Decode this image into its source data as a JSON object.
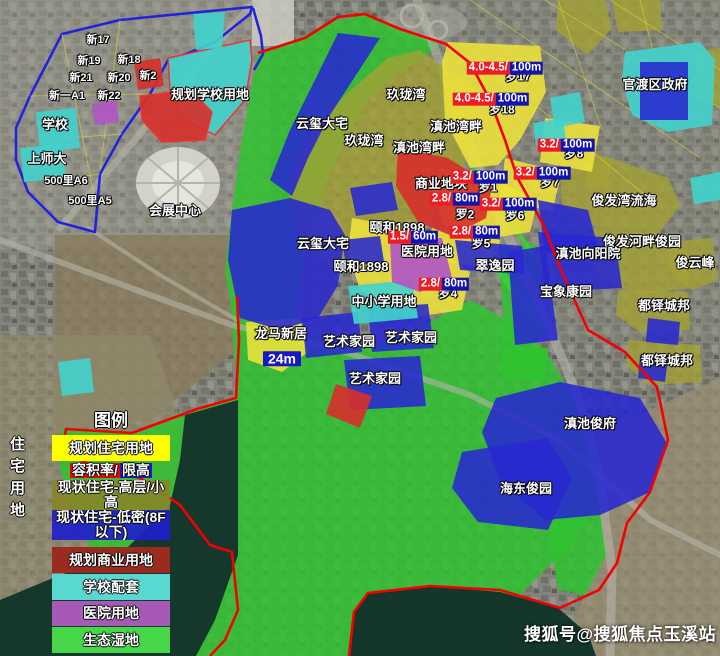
{
  "watermark": "搜狐号@搜狐焦点玉溪站",
  "left_edge_vertical_text": "住宅用地",
  "legend": {
    "title": "图例",
    "items": [
      {
        "type": "plain",
        "text": "规划住宅用地",
        "bg": "#ffff00",
        "h": 26,
        "gap": 0
      },
      {
        "type": "split",
        "h": 17,
        "gap": 1,
        "parts": [
          {
            "text": "容积率/",
            "bg": "#f00000"
          },
          {
            "text": "限高",
            "bg": "#1b1bc4"
          }
        ]
      },
      {
        "type": "plain",
        "text": "现状住宅-高层/小高",
        "bg": "rgba(134,134,40,0.9)",
        "h": 30,
        "gap": 1
      },
      {
        "type": "plain",
        "text": "现状住宅-低密(8F以下)",
        "bg": "rgba(32,32,204,0.92)",
        "h": 30,
        "gap": 0
      },
      {
        "type": "plain",
        "text": "规划商业用地",
        "bg": "#9c2b1f",
        "h": 26,
        "gap": 7
      },
      {
        "type": "plain",
        "text": "学校配套",
        "bg": "#58d8d0",
        "h": 26,
        "gap": 1
      },
      {
        "type": "plain",
        "text": "医院用地",
        "bg": "#a75ab5",
        "h": 25,
        "gap": 1
      },
      {
        "type": "plain",
        "text": "生态湿地",
        "bg": "#47d549",
        "h": 26,
        "gap": 1
      }
    ]
  },
  "palette": {
    "planned_residential_yellow": "#eee23a",
    "existing_highrise_olive": "#a4a134",
    "existing_lowdensity_blue": "#2828d0",
    "eco_wetland_green": "#2fc32f",
    "school_cyan": "#41d3cd",
    "commercial_red": "#d6312b",
    "hospital_purple": "#b156c3",
    "plot_ratio_bg_red": "#ee1c25",
    "height_limit_bg_navy": "#1515ad",
    "boundary_red": "#f50000",
    "boundary_blue": "#2121e0"
  },
  "map_labels": [
    {
      "t": "blocksm",
      "text": "新17",
      "x": 98,
      "y": 40
    },
    {
      "t": "blocksm",
      "text": "新19",
      "x": 89,
      "y": 61
    },
    {
      "t": "blocksm",
      "text": "新18",
      "x": 129,
      "y": 60
    },
    {
      "t": "blocksm",
      "text": "新21",
      "x": 81,
      "y": 78
    },
    {
      "t": "blocksm",
      "text": "新20",
      "x": 119,
      "y": 78
    },
    {
      "t": "blocksm",
      "text": "新2",
      "x": 148,
      "y": 76
    },
    {
      "t": "blocksm",
      "text": "新一A1",
      "x": 67,
      "y": 96
    },
    {
      "t": "blocksm",
      "text": "新22",
      "x": 109,
      "y": 96
    },
    {
      "t": "blocksm",
      "text": "500里A6",
      "x": 66,
      "y": 181
    },
    {
      "t": "blocksm",
      "text": "500里A5",
      "x": 90,
      "y": 201
    },
    {
      "t": "place",
      "text": "学校",
      "x": 55,
      "y": 125
    },
    {
      "t": "place",
      "text": "上师大",
      "x": 47,
      "y": 159
    },
    {
      "t": "place",
      "text": "规划学校用地",
      "x": 210,
      "y": 95
    },
    {
      "t": "place",
      "text": "会展中心",
      "x": 175,
      "y": 211
    },
    {
      "t": "place",
      "text": "云玺大宅",
      "x": 322,
      "y": 124
    },
    {
      "t": "place",
      "text": "云玺大宅",
      "x": 323,
      "y": 244
    },
    {
      "t": "place",
      "text": "玖珑湾",
      "x": 406,
      "y": 95
    },
    {
      "t": "place",
      "text": "玖珑湾",
      "x": 364,
      "y": 141
    },
    {
      "t": "place",
      "text": "滇池湾畔",
      "x": 456,
      "y": 127
    },
    {
      "t": "place",
      "text": "滇池湾畔",
      "x": 419,
      "y": 148
    },
    {
      "t": "place",
      "text": "商业地块",
      "x": 441,
      "y": 184
    },
    {
      "t": "place",
      "text": "颐和1898",
      "x": 397,
      "y": 228
    },
    {
      "t": "place",
      "text": "颐和1898",
      "x": 361,
      "y": 267
    },
    {
      "t": "place",
      "text": "医院用地",
      "x": 427,
      "y": 252
    },
    {
      "t": "place",
      "text": "中小学用地",
      "x": 384,
      "y": 302
    },
    {
      "t": "place",
      "text": "翠逸园",
      "x": 495,
      "y": 266
    },
    {
      "t": "place",
      "text": "龙马新居",
      "x": 281,
      "y": 334
    },
    {
      "t": "place",
      "text": "艺术家园",
      "x": 349,
      "y": 342
    },
    {
      "t": "place",
      "text": "艺术家园",
      "x": 411,
      "y": 338
    },
    {
      "t": "place",
      "text": "艺术家园",
      "x": 375,
      "y": 379
    },
    {
      "t": "place",
      "text": "官渡区政府",
      "x": 655,
      "y": 85
    },
    {
      "t": "place",
      "text": "俊发湾流海",
      "x": 624,
      "y": 201
    },
    {
      "t": "place",
      "text": "俊发河畔俊园",
      "x": 642,
      "y": 242
    },
    {
      "t": "place",
      "text": "滇池向阳院",
      "x": 588,
      "y": 254
    },
    {
      "t": "place",
      "text": "俊云峰",
      "x": 695,
      "y": 263
    },
    {
      "t": "place",
      "text": "宝象康园",
      "x": 566,
      "y": 292
    },
    {
      "t": "place",
      "text": "都铎城邦",
      "x": 664,
      "y": 306
    },
    {
      "t": "place",
      "text": "都铎城邦",
      "x": 667,
      "y": 361
    },
    {
      "t": "place",
      "text": "滇池俊府",
      "x": 590,
      "y": 424
    },
    {
      "t": "place",
      "text": "海东俊园",
      "x": 526,
      "y": 489
    },
    {
      "t": "block",
      "text": "罗17",
      "x": 518,
      "y": 77
    },
    {
      "t": "block",
      "text": "罗18",
      "x": 502,
      "y": 110
    },
    {
      "t": "block",
      "text": "罗8",
      "x": 574,
      "y": 154
    },
    {
      "t": "block",
      "text": "罗7",
      "x": 550,
      "y": 183
    },
    {
      "t": "block",
      "text": "罗1",
      "x": 488,
      "y": 188
    },
    {
      "t": "block",
      "text": "罗2",
      "x": 465,
      "y": 215
    },
    {
      "t": "block",
      "text": "罗6",
      "x": 515,
      "y": 216
    },
    {
      "t": "block",
      "text": "罗5",
      "x": 481,
      "y": 244
    },
    {
      "t": "block",
      "text": "罗4",
      "x": 448,
      "y": 294
    },
    {
      "t": "tag",
      "text": "24m",
      "x": 282,
      "y": 359
    }
  ],
  "price_labels": [
    {
      "ratio": "4.0-4.5/",
      "height": "100m",
      "x": 505,
      "y": 68
    },
    {
      "ratio": "4.0-4.5/",
      "height": "100m",
      "x": 491,
      "y": 99
    },
    {
      "ratio": "3.2/",
      "height": "100m",
      "x": 566,
      "y": 145
    },
    {
      "ratio": "3.2/",
      "height": "100m",
      "x": 542,
      "y": 173
    },
    {
      "ratio": "3.2/",
      "height": "100m",
      "x": 479,
      "y": 177
    },
    {
      "ratio": "2.8/",
      "height": "80m",
      "x": 455,
      "y": 199
    },
    {
      "ratio": "3.2/",
      "height": "100m",
      "x": 508,
      "y": 204
    },
    {
      "ratio": "2.8/",
      "height": "80m",
      "x": 475,
      "y": 232
    },
    {
      "ratio": "1.5/",
      "height": "60m",
      "x": 413,
      "y": 237
    },
    {
      "ratio": "2.8/",
      "height": "80m",
      "x": 444,
      "y": 284
    }
  ]
}
